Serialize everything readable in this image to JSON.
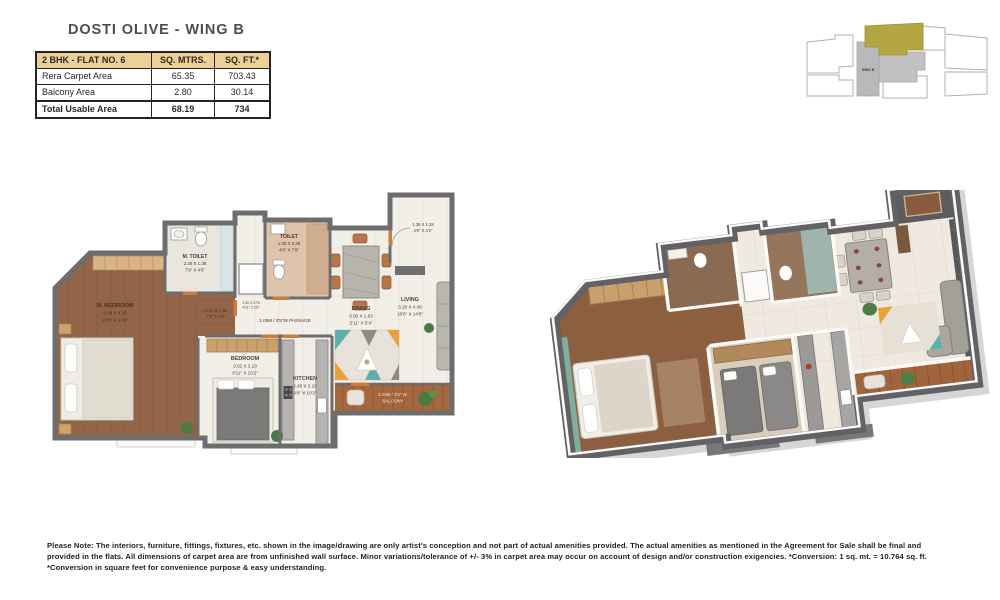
{
  "title": "DOSTI OLIVE - WING B",
  "table": {
    "header": [
      "2 BHK - FLAT NO. 6",
      "SQ. MTRS.",
      "SQ. FT.*"
    ],
    "rows": [
      {
        "label": "Rera Carpet Area",
        "mtrs": "65.35",
        "ft": "703.43"
      },
      {
        "label": "Balcony Area",
        "mtrs": "2.80",
        "ft": "30.14"
      },
      {
        "label": "Total Usable Area",
        "mtrs": "68.19",
        "ft": "734"
      }
    ]
  },
  "keyplan": {
    "wing_label": "WING B",
    "highlight_color": "#b4a742"
  },
  "plan2d": {
    "rooms": {
      "m_bedroom": {
        "name": "M. BEDROOM",
        "m": "3.20 X 4.20",
        "ft": "10'6\" X 13'9\""
      },
      "m_toilet": {
        "name": "M. TOILET",
        "m": "2.38 X 1.38",
        "ft": "7'9\" X 4'6\""
      },
      "toilet": {
        "name": "TOILET",
        "m": "1.38 X 2.38",
        "ft": "4'6\" X 7'9\""
      },
      "bedroom": {
        "name": "BEDROOM",
        "m": "3.02 X 3.10",
        "ft": "9'11\" X 10'2\""
      },
      "kitchen": {
        "name": "KITCHEN",
        "m": "2.45 X 3.10",
        "ft": "8'0\" X 10'2\""
      },
      "dining": {
        "name": "DINING",
        "m": "0.90 X 1.63",
        "ft": "2'11\" X 5'4\""
      },
      "living": {
        "name": "LIVING",
        "m": "3.20 X 4.48",
        "ft": "10'6\" X 14'8\""
      }
    },
    "passage_label": "1.05M / 3'5\"W PASSAGE",
    "balcony_line1": "1.00M / 3'3\" W.",
    "balcony_line2": "BALCONY",
    "dressing": {
      "m": "2.17 X 1.35",
      "ft": "7'1\" X 4'5\""
    },
    "foyer": {
      "m": "1.38 X 1.28",
      "ft": "4'6\" X 4'2\""
    },
    "shaft": {
      "m": "1.50 X 0.75",
      "ft": "4'11\" X 2'6\""
    }
  },
  "colors": {
    "table_header": "#ecd098",
    "keyplan_highlight": "#b4a742",
    "wall_gray": "#6d6d6f",
    "door_accent": "#c67f41",
    "wood_floor": "#8f6142",
    "balcony_wood": "#a5673d"
  },
  "disclaimer": "Please Note: The interiors, furniture, fittings, fixtures, etc. shown in the image/drawing are only artist's conception and not part of actual amenities provided. The actual amenities as mentioned in the Agreement for Sale shall be final and provided in the flats. All dimensions of carpet area are from unfinished wall surface. Minor variations/tolerance of +/- 3% in carpet area may occur on account of design and/or construction exigencies. *Conversion: 1 sq. mt. = 10.764 sq. ft. *Conversion in square feet for convenience purpose & easy understanding."
}
